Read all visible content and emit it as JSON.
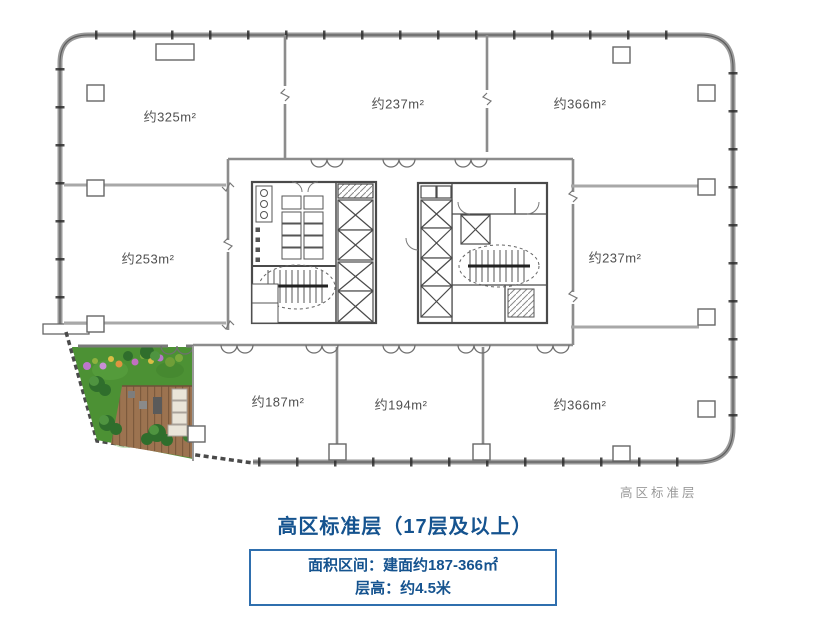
{
  "plan": {
    "rooms": [
      {
        "name": "top-left",
        "label": "约325m²"
      },
      {
        "name": "top-middle",
        "label": "约237m²"
      },
      {
        "name": "top-right",
        "label": "约366m²"
      },
      {
        "name": "mid-left",
        "label": "约253m²"
      },
      {
        "name": "mid-right",
        "label": "约237m²"
      },
      {
        "name": "bottom-left",
        "label": "约187m²"
      },
      {
        "name": "bottom-middle",
        "label": "约194m²"
      },
      {
        "name": "bottom-right",
        "label": "约366m²"
      }
    ],
    "corner_note": "高区标准层"
  },
  "caption": {
    "title": "高区标准层（17层及以上）",
    "area_range": "面积区间：建面约187-366㎡",
    "floor_height": "层高：约4.5米"
  },
  "colors": {
    "accent_blue": "#15538f",
    "box_border_blue": "#2f6fae",
    "wall_gray": "#8f8f8f",
    "grass_green": "#4c9134",
    "deck_brown": "#9c7350",
    "note_gray": "#9a9a9a"
  }
}
